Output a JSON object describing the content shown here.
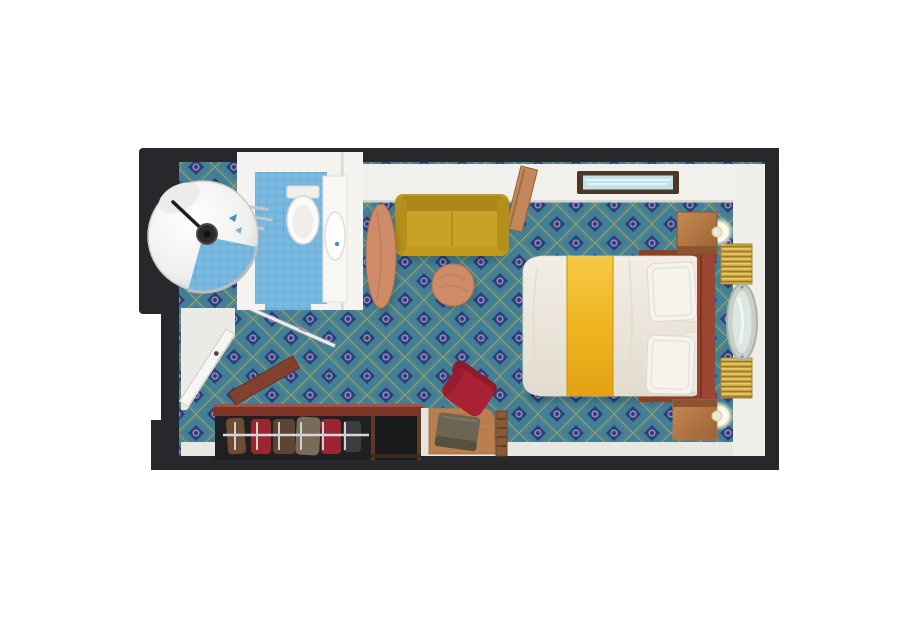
{
  "floorplan": {
    "type": "stateroom-top-down-render",
    "rooms": [
      {
        "name": "bathroom",
        "fixtures": [
          "circular-shower",
          "shower-head",
          "toilet",
          "sink-vanity",
          "towel-rails",
          "glass-door",
          "blue-tile-floor"
        ]
      },
      {
        "name": "cabin",
        "furniture": [
          "entrance-door",
          "sofa",
          "oval-side-table",
          "round-coffee-table",
          "double-bed",
          "gold-bed-runner",
          "pillows",
          "headboard",
          "nightstand-top",
          "nightstand-bottom",
          "bedside-lamps",
          "wall-picture",
          "open-cabinet-door",
          "porthole-mirror",
          "woven-wall-panels",
          "wardrobe-with-clothes",
          "open-shelf-cube",
          "desk",
          "ottoman",
          "red-chair",
          "towel-ladder"
        ]
      }
    ],
    "colors": {
      "page_bg": "#ffffff",
      "walls": "#26282b",
      "wall_face": "#f2f0ec",
      "floor_strip": "#e9e7e1",
      "entry_floor": "#eceae6",
      "carpet_base": "#427e95",
      "carpet_diamond": "#2d3f72",
      "carpet_dot": "#8e86c4",
      "carpet_lattice": "#a8ab5e",
      "tile": "#79b9e0",
      "tile_line": "#59a0cd",
      "bathroom_walls": "#f4f3ef",
      "sofa_body": "#bf9a1d",
      "sofa_back": "#a98718",
      "sofa_seat": "#c7a226",
      "table_wood": "#ce8b67",
      "duvet": "#efeae0",
      "bed_gold": "#edb21e",
      "bed_frame": "#9a4630",
      "pillow": "#f6f3ec",
      "nightstand_wood": "#b3794e",
      "weave_panel": "#c9a23b",
      "porthole_frame": "#c9cfc9",
      "porthole_glass": "#dde6e2",
      "picture_frame": "#4c3826",
      "picture_art": "#c3dfe8",
      "closet_wood": "#7d3428",
      "clothes_red": "#9d2431",
      "clothes_brown": "#5d4434",
      "chair_red": "#a92135",
      "desk_wood": "#bb7e4e",
      "ottoman_olive": "#6b6654",
      "lamp_glow": "#fffdf2"
    }
  }
}
